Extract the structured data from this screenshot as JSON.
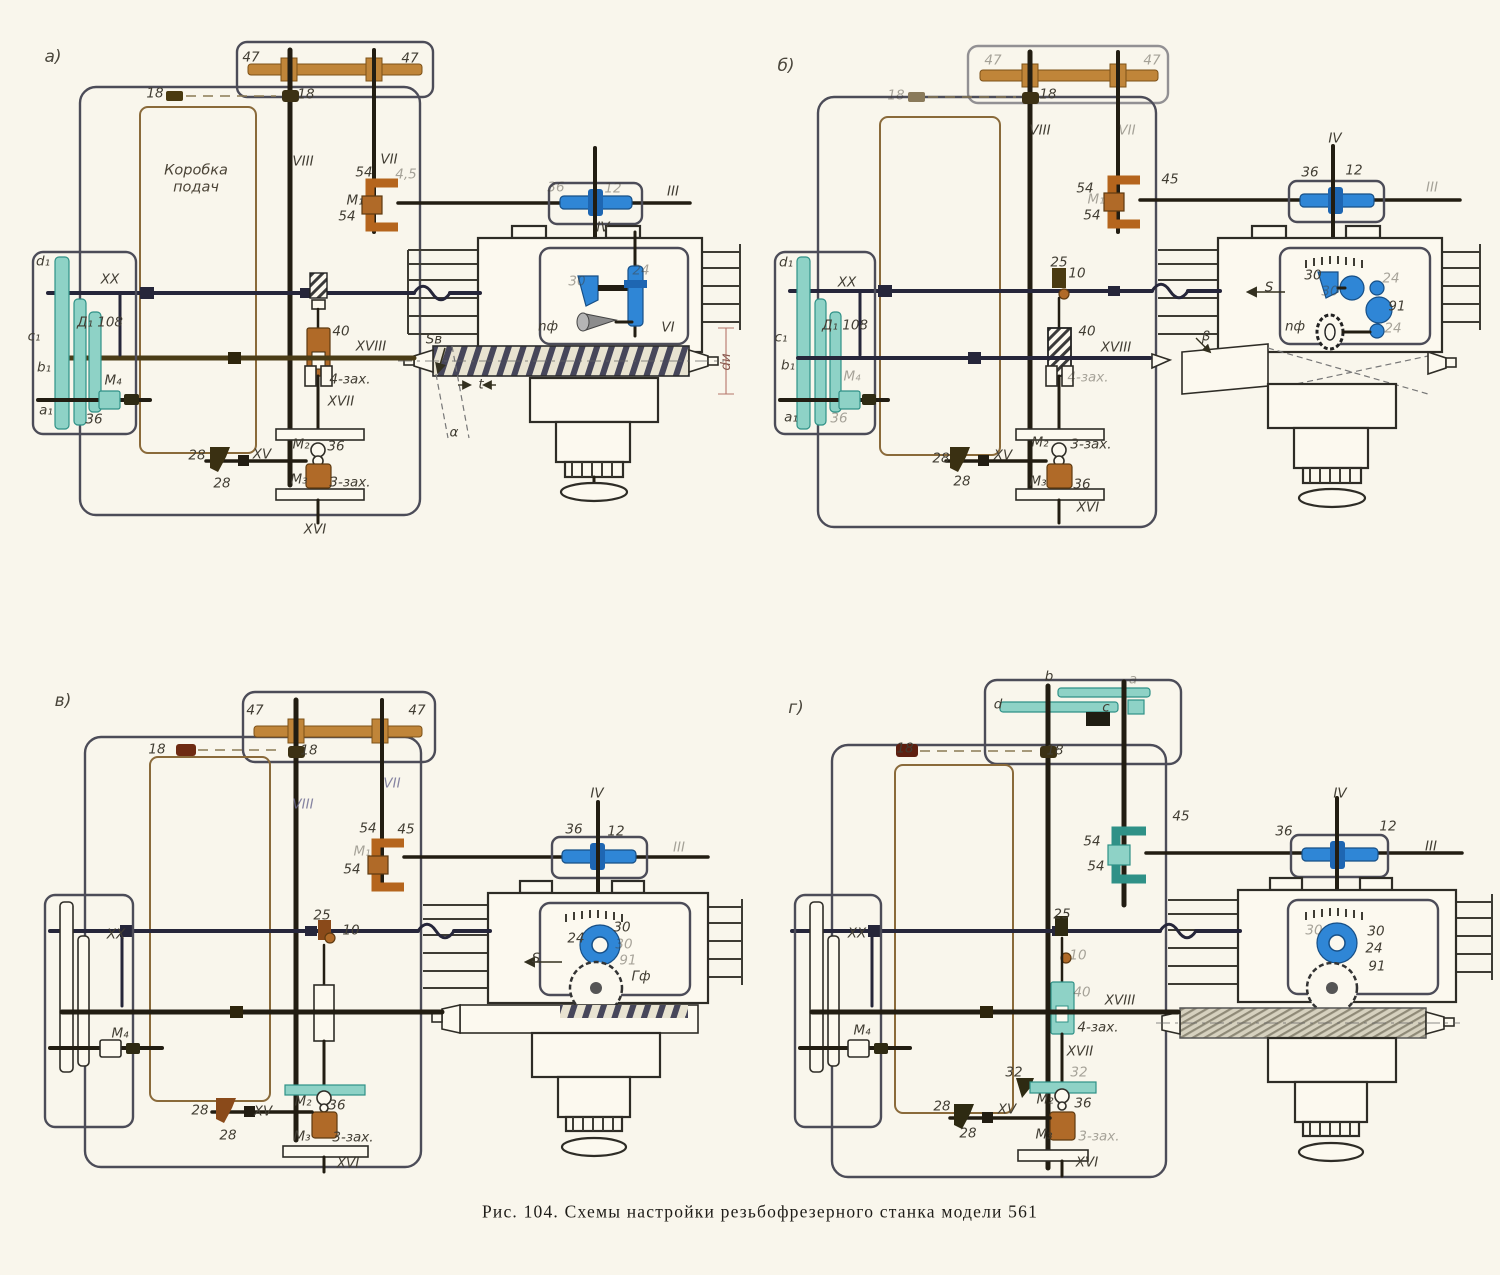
{
  "figure": {
    "caption": "Рис. 104. Схемы настройки резьбофрезерного станка модели 561",
    "model": "561"
  },
  "colors": {
    "background": "#f9f6ec",
    "blue_gear": "#2f86d6",
    "teal_gear": "#8ed2c6",
    "orange_clutch": "#b5651d",
    "tan_shaft": "#c08539",
    "navy_shaft": "#26263a"
  },
  "panels": [
    {
      "id": "a",
      "letter": "а)",
      "labels": [
        {
          "t": "а)",
          "x": 53,
          "y": 59,
          "c": "big"
        },
        {
          "t": "47",
          "x": 251,
          "y": 59
        },
        {
          "t": "47",
          "x": 410,
          "y": 60
        },
        {
          "t": "18",
          "x": 155,
          "y": 95
        },
        {
          "t": "18",
          "x": 306,
          "y": 96
        },
        {
          "t": "VIII",
          "x": 303,
          "y": 163
        },
        {
          "t": "VII",
          "x": 389,
          "y": 161
        },
        {
          "t": "4,5",
          "x": 406,
          "y": 176,
          "c": "faded"
        },
        {
          "t": "54",
          "x": 364,
          "y": 174
        },
        {
          "t": "M₁",
          "x": 355,
          "y": 202
        },
        {
          "t": "54",
          "x": 347,
          "y": 218
        },
        {
          "t": "Коробка\nподач",
          "x": 196,
          "y": 181,
          "c": "box"
        },
        {
          "t": "III",
          "x": 673,
          "y": 193
        },
        {
          "t": "36",
          "x": 556,
          "y": 189,
          "c": "faded"
        },
        {
          "t": "12",
          "x": 613,
          "y": 190,
          "c": "faded"
        },
        {
          "t": "IV",
          "x": 603,
          "y": 229
        },
        {
          "t": "30",
          "x": 577,
          "y": 283,
          "c": "faded"
        },
        {
          "t": "24",
          "x": 641,
          "y": 272,
          "c": "faded"
        },
        {
          "t": "VI",
          "x": 668,
          "y": 329
        },
        {
          "t": "nф",
          "x": 548,
          "y": 328
        },
        {
          "t": "XX",
          "x": 110,
          "y": 281
        },
        {
          "t": "Д₁ 108",
          "x": 100,
          "y": 324
        },
        {
          "t": "M₄",
          "x": 113,
          "y": 382
        },
        {
          "t": "36",
          "x": 94,
          "y": 421
        },
        {
          "t": "d₁",
          "x": 43,
          "y": 263
        },
        {
          "t": "c₁",
          "x": 34,
          "y": 338
        },
        {
          "t": "b₁",
          "x": 44,
          "y": 369
        },
        {
          "t": "a₁",
          "x": 46,
          "y": 412
        },
        {
          "t": "40",
          "x": 341,
          "y": 333
        },
        {
          "t": "XVIII",
          "x": 371,
          "y": 348
        },
        {
          "t": "4-зах.",
          "x": 350,
          "y": 381
        },
        {
          "t": "XVII",
          "x": 341,
          "y": 403
        },
        {
          "t": "M₂",
          "x": 301,
          "y": 446
        },
        {
          "t": "36",
          "x": 336,
          "y": 448
        },
        {
          "t": "M₃",
          "x": 299,
          "y": 481
        },
        {
          "t": "3-зах.",
          "x": 350,
          "y": 484
        },
        {
          "t": "28",
          "x": 197,
          "y": 457
        },
        {
          "t": "28",
          "x": 222,
          "y": 485
        },
        {
          "t": "XV",
          "x": 262,
          "y": 456
        },
        {
          "t": "XVI",
          "x": 315,
          "y": 531
        },
        {
          "t": "Sв",
          "x": 434,
          "y": 341
        },
        {
          "t": "t",
          "x": 481,
          "y": 386
        },
        {
          "t": "α",
          "x": 454,
          "y": 434
        },
        {
          "t": "dи",
          "x": 727,
          "y": 362,
          "c": "rot"
        }
      ]
    },
    {
      "id": "b",
      "letter": "б)",
      "labels": [
        {
          "t": "б)",
          "x": 786,
          "y": 68,
          "c": "big"
        },
        {
          "t": "47",
          "x": 993,
          "y": 62,
          "c": "faded"
        },
        {
          "t": "47",
          "x": 1152,
          "y": 62,
          "c": "faded"
        },
        {
          "t": "18",
          "x": 896,
          "y": 97,
          "c": "faded"
        },
        {
          "t": "18",
          "x": 1048,
          "y": 96
        },
        {
          "t": "VIII",
          "x": 1040,
          "y": 132
        },
        {
          "t": "VII",
          "x": 1127,
          "y": 132,
          "c": "faded"
        },
        {
          "t": "45",
          "x": 1170,
          "y": 181
        },
        {
          "t": "54",
          "x": 1085,
          "y": 190
        },
        {
          "t": "M₁",
          "x": 1096,
          "y": 201,
          "c": "faded"
        },
        {
          "t": "54",
          "x": 1092,
          "y": 217
        },
        {
          "t": "III",
          "x": 1432,
          "y": 189,
          "c": "faded"
        },
        {
          "t": "36",
          "x": 1310,
          "y": 174
        },
        {
          "t": "12",
          "x": 1354,
          "y": 172
        },
        {
          "t": "IV",
          "x": 1335,
          "y": 140
        },
        {
          "t": "25",
          "x": 1059,
          "y": 264
        },
        {
          "t": "10",
          "x": 1077,
          "y": 275
        },
        {
          "t": "30",
          "x": 1313,
          "y": 277
        },
        {
          "t": "30",
          "x": 1330,
          "y": 293,
          "c": "faded"
        },
        {
          "t": "24",
          "x": 1391,
          "y": 280,
          "c": "faded"
        },
        {
          "t": "91",
          "x": 1397,
          "y": 308
        },
        {
          "t": "24",
          "x": 1393,
          "y": 330,
          "c": "faded"
        },
        {
          "t": "S",
          "x": 1269,
          "y": 289
        },
        {
          "t": "nф",
          "x": 1295,
          "y": 328
        },
        {
          "t": "β",
          "x": 1206,
          "y": 338
        },
        {
          "t": "XX",
          "x": 847,
          "y": 284
        },
        {
          "t": "Д₁ 108",
          "x": 845,
          "y": 327
        },
        {
          "t": "M₄",
          "x": 852,
          "y": 378,
          "c": "faded"
        },
        {
          "t": "36",
          "x": 839,
          "y": 420,
          "c": "faded"
        },
        {
          "t": "d₁",
          "x": 786,
          "y": 264
        },
        {
          "t": "c₁",
          "x": 781,
          "y": 339
        },
        {
          "t": "b₁",
          "x": 788,
          "y": 367
        },
        {
          "t": "a₁",
          "x": 791,
          "y": 419
        },
        {
          "t": "40",
          "x": 1087,
          "y": 333
        },
        {
          "t": "XVIII",
          "x": 1116,
          "y": 349
        },
        {
          "t": "4-зах.",
          "x": 1088,
          "y": 379,
          "c": "faded"
        },
        {
          "t": "28",
          "x": 941,
          "y": 460
        },
        {
          "t": "28",
          "x": 962,
          "y": 483
        },
        {
          "t": "XV",
          "x": 1003,
          "y": 457
        },
        {
          "t": "M₂",
          "x": 1040,
          "y": 444
        },
        {
          "t": "3-зах.",
          "x": 1091,
          "y": 446
        },
        {
          "t": "M₃",
          "x": 1038,
          "y": 483
        },
        {
          "t": "36",
          "x": 1082,
          "y": 486
        },
        {
          "t": "XVI",
          "x": 1088,
          "y": 509
        }
      ]
    },
    {
      "id": "v",
      "letter": "в)",
      "labels": [
        {
          "t": "в)",
          "x": 63,
          "y": 703,
          "c": "big"
        },
        {
          "t": "47",
          "x": 255,
          "y": 712
        },
        {
          "t": "47",
          "x": 417,
          "y": 712
        },
        {
          "t": "18",
          "x": 157,
          "y": 751
        },
        {
          "t": "18",
          "x": 309,
          "y": 752
        },
        {
          "t": "VIII",
          "x": 303,
          "y": 806,
          "c": "blu"
        },
        {
          "t": "VII",
          "x": 392,
          "y": 785,
          "c": "blu"
        },
        {
          "t": "54",
          "x": 368,
          "y": 830
        },
        {
          "t": "45",
          "x": 406,
          "y": 831
        },
        {
          "t": "M₁",
          "x": 362,
          "y": 853,
          "c": "faded"
        },
        {
          "t": "54",
          "x": 352,
          "y": 871
        },
        {
          "t": "36",
          "x": 574,
          "y": 831
        },
        {
          "t": "12",
          "x": 616,
          "y": 833
        },
        {
          "t": "IV",
          "x": 597,
          "y": 795
        },
        {
          "t": "III",
          "x": 679,
          "y": 849,
          "c": "faded"
        },
        {
          "t": "25",
          "x": 322,
          "y": 917
        },
        {
          "t": "10",
          "x": 351,
          "y": 932
        },
        {
          "t": "XX",
          "x": 116,
          "y": 936
        },
        {
          "t": "24",
          "x": 576,
          "y": 940
        },
        {
          "t": "30",
          "x": 622,
          "y": 929
        },
        {
          "t": "30",
          "x": 624,
          "y": 946,
          "c": "faded"
        },
        {
          "t": "91",
          "x": 628,
          "y": 962,
          "c": "faded"
        },
        {
          "t": "S",
          "x": 536,
          "y": 960
        },
        {
          "t": "Гф",
          "x": 641,
          "y": 978
        },
        {
          "t": "M₄",
          "x": 120,
          "y": 1035
        },
        {
          "t": "M₂",
          "x": 303,
          "y": 1103
        },
        {
          "t": "36",
          "x": 337,
          "y": 1107
        },
        {
          "t": "M₃",
          "x": 302,
          "y": 1138
        },
        {
          "t": "3-зах.",
          "x": 353,
          "y": 1139
        },
        {
          "t": "28",
          "x": 200,
          "y": 1112
        },
        {
          "t": "28",
          "x": 228,
          "y": 1137
        },
        {
          "t": "XV",
          "x": 263,
          "y": 1113
        },
        {
          "t": "XVI",
          "x": 348,
          "y": 1165
        }
      ]
    },
    {
      "id": "g",
      "letter": "г)",
      "labels": [
        {
          "t": "г)",
          "x": 796,
          "y": 710,
          "c": "big"
        },
        {
          "t": "d",
          "x": 998,
          "y": 706
        },
        {
          "t": "b",
          "x": 1049,
          "y": 678
        },
        {
          "t": "c",
          "x": 1106,
          "y": 709
        },
        {
          "t": "a",
          "x": 1133,
          "y": 681,
          "c": "faded"
        },
        {
          "t": "18",
          "x": 905,
          "y": 750
        },
        {
          "t": "18",
          "x": 1055,
          "y": 752
        },
        {
          "t": "45",
          "x": 1181,
          "y": 818
        },
        {
          "t": "54",
          "x": 1092,
          "y": 843
        },
        {
          "t": "54",
          "x": 1096,
          "y": 868
        },
        {
          "t": "36",
          "x": 1284,
          "y": 833
        },
        {
          "t": "12",
          "x": 1388,
          "y": 828
        },
        {
          "t": "IV",
          "x": 1340,
          "y": 795
        },
        {
          "t": "III",
          "x": 1431,
          "y": 848
        },
        {
          "t": "25",
          "x": 1062,
          "y": 916
        },
        {
          "t": "10",
          "x": 1078,
          "y": 957,
          "c": "faded"
        },
        {
          "t": "XX",
          "x": 857,
          "y": 935
        },
        {
          "t": "30",
          "x": 1314,
          "y": 932,
          "c": "faded"
        },
        {
          "t": "30",
          "x": 1376,
          "y": 933
        },
        {
          "t": "24",
          "x": 1374,
          "y": 950
        },
        {
          "t": "91",
          "x": 1377,
          "y": 968
        },
        {
          "t": "M₄",
          "x": 862,
          "y": 1032
        },
        {
          "t": "40",
          "x": 1082,
          "y": 994,
          "c": "faded"
        },
        {
          "t": "XVIII",
          "x": 1120,
          "y": 1002
        },
        {
          "t": "4-зах.",
          "x": 1098,
          "y": 1029
        },
        {
          "t": "XVII",
          "x": 1080,
          "y": 1053
        },
        {
          "t": "32",
          "x": 1014,
          "y": 1074
        },
        {
          "t": "32",
          "x": 1079,
          "y": 1074,
          "c": "faded"
        },
        {
          "t": "M₂",
          "x": 1045,
          "y": 1101
        },
        {
          "t": "36",
          "x": 1083,
          "y": 1105
        },
        {
          "t": "M₃",
          "x": 1044,
          "y": 1136
        },
        {
          "t": "3-зах.",
          "x": 1099,
          "y": 1138,
          "c": "faded"
        },
        {
          "t": "28",
          "x": 942,
          "y": 1108
        },
        {
          "t": "28",
          "x": 968,
          "y": 1135
        },
        {
          "t": "XV",
          "x": 1007,
          "y": 1111
        },
        {
          "t": "XVI",
          "x": 1087,
          "y": 1164
        }
      ]
    }
  ]
}
